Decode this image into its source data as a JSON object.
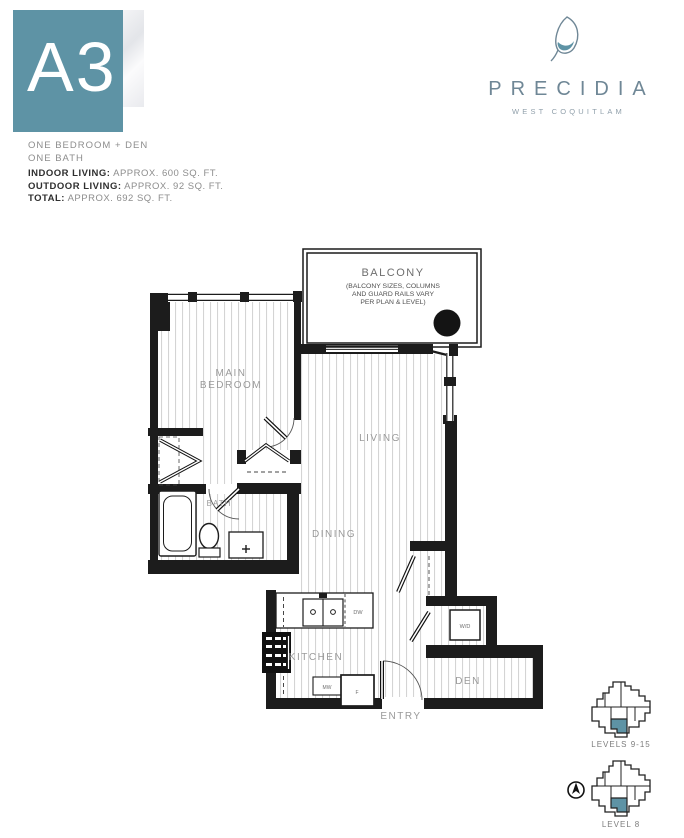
{
  "header": {
    "unit_code": "A3",
    "type_line1": "ONE BEDROOM + DEN",
    "type_line2": "ONE BATH",
    "stats": [
      {
        "label": "INDOOR LIVING:",
        "value": "APPROX. 600 SQ. FT."
      },
      {
        "label": "OUTDOOR LIVING:",
        "value": "APPROX. 92 SQ. FT."
      },
      {
        "label": "TOTAL:",
        "value": "APPROX. 692 SQ. FT."
      }
    ]
  },
  "brand": {
    "name": "PRECIDIA",
    "tagline": "WEST COQUITLAM"
  },
  "plan": {
    "balcony": {
      "label": "BALCONY",
      "note1": "(BALCONY SIZES, COLUMNS",
      "note2": "AND GUARD RAILS VARY",
      "note3": "PER PLAN & LEVEL)"
    },
    "rooms": {
      "main_bedroom_1": "MAIN",
      "main_bedroom_2": "BEDROOM",
      "living": "LIVING",
      "dining": "DINING",
      "bath": "BATH",
      "kitchen": "KITCHEN",
      "den": "DEN",
      "entry": "ENTRY"
    },
    "fixtures": {
      "dishwasher": "DW",
      "microwave": "MW",
      "fridge": "F",
      "washer_dryer": "W/D"
    }
  },
  "keyplans": [
    {
      "label": "LEVELS 9-15"
    },
    {
      "label": "LEVEL 8"
    }
  ],
  "colors": {
    "accent": "#5e93a5",
    "wall": "#1c1c1c",
    "label_gray": "#9a9a9a"
  }
}
